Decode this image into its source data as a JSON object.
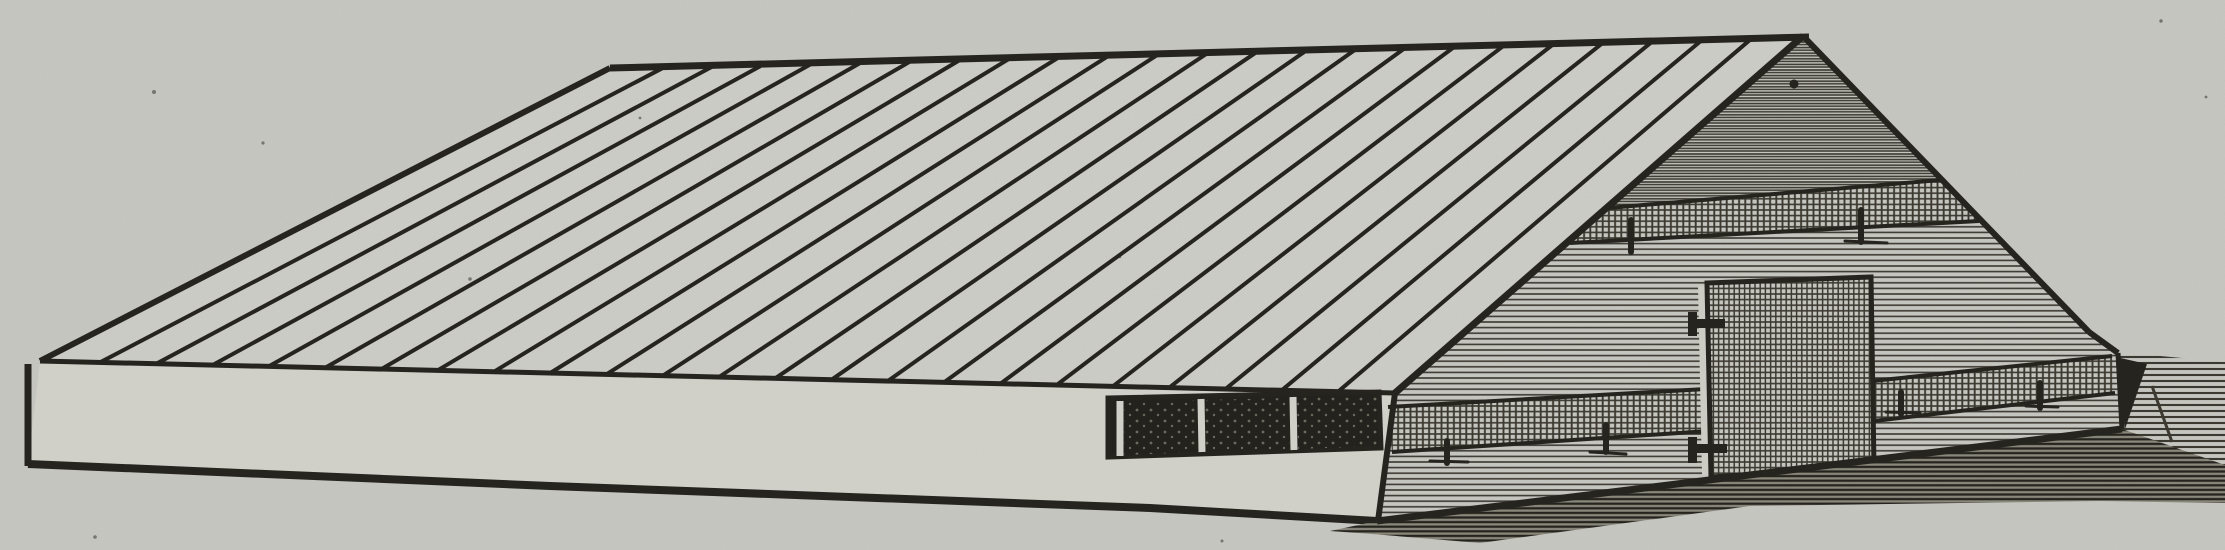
{
  "figure": {
    "type": "woodcut-engraving",
    "subject": "Vintage engraving of a long low shed-roofed poultry house seen from the front-left: a broad plank roof with diagonal board seams, a low light front wall with a band of three dark window openings near its right end, and a hatched gable end wall with a vertical-board door on the right",
    "style": "19th-century black-ink woodcut printed on gray book paper"
  },
  "colors": {
    "paper": "#c8c8c3",
    "figure_paper": "#cecec8",
    "wall_light": "#d3d3cc",
    "ink": "#25231d",
    "ink_soft": "#3b382f",
    "window_dark": "#23211c",
    "window_fleck": "#6e6a5e",
    "shadow_base": "#8b887c",
    "jamb_light": "#cfcfc8"
  },
  "roof": {
    "board_seam_count": 23,
    "description": "single broad slope of parallel planks"
  },
  "window_band": {
    "pane_count": 3,
    "description": "row of three dark openings under the eave"
  },
  "door": {
    "hinge_count": 2,
    "description": "vertical-board door with two strap hinges on left side"
  },
  "gable": {
    "bands": [
      "upper girt band",
      "lower skirt band"
    ],
    "texture": "fine horizontal siding hatch"
  },
  "ground": {
    "texture": "horizontal hatch shadow under wall and open ground at right"
  }
}
